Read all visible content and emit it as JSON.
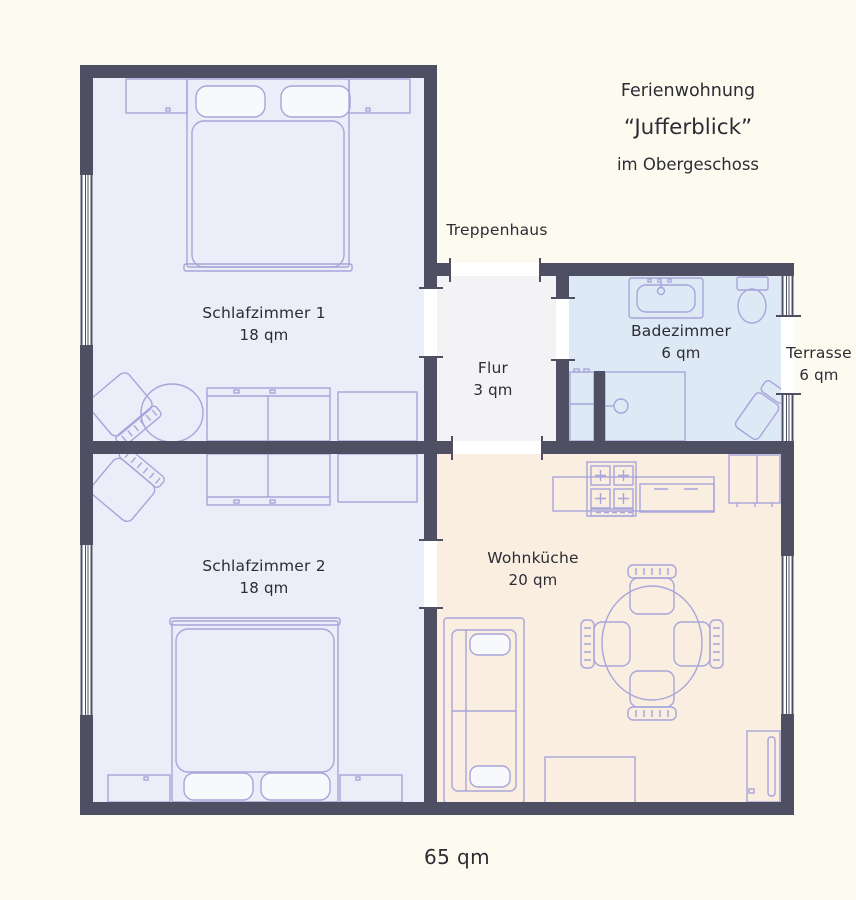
{
  "title": {
    "line1": "Ferienwohnung",
    "line2": "“Jufferblick”",
    "line3": "im Obergeschoss"
  },
  "total_area_label": "65 qm",
  "rooms": {
    "schlafzimmer1": {
      "name": "Schlafzimmer 1",
      "area": "18 qm"
    },
    "schlafzimmer2": {
      "name": "Schlafzimmer 2",
      "area": "18 qm"
    },
    "flur": {
      "name": "Flur",
      "area": "3 qm"
    },
    "badezimmer": {
      "name": "Badezimmer",
      "area": "6 qm"
    },
    "terrasse": {
      "name": "Terrasse",
      "area": "6 qm"
    },
    "wohnkueche": {
      "name": "Wohnküche",
      "area": "20 qm"
    },
    "treppenhaus": {
      "name": "Treppenhaus"
    }
  },
  "colors": {
    "background": "#fdfbef",
    "wall": "#4e4f63",
    "bedroom_floor": "#ebedf8",
    "bathroom_floor": "#dee9f6",
    "hall_floor": "#f3f3f5",
    "kitchen_floor": "#faeee1",
    "furniture_line": "#a7a5d9",
    "text": "#2c2c35"
  }
}
